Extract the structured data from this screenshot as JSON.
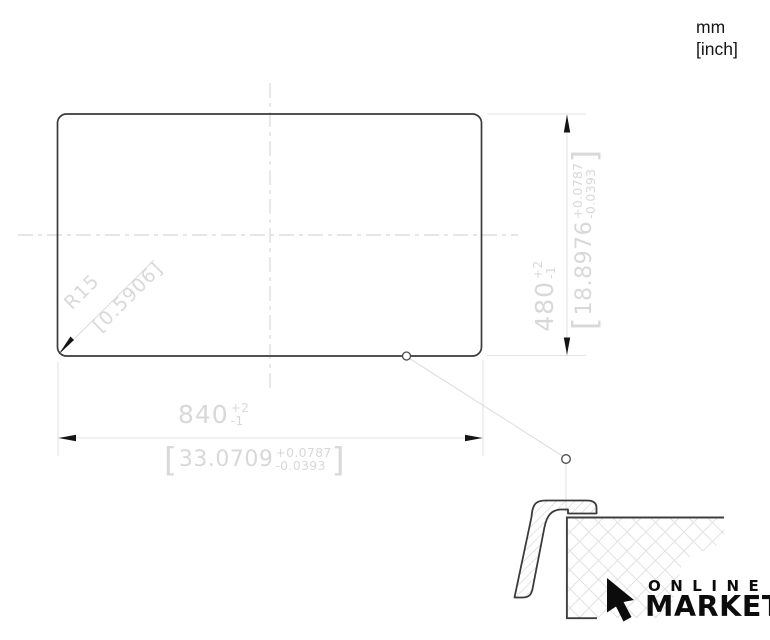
{
  "units": {
    "mm": "mm",
    "inch": "[inch]"
  },
  "symbols": {
    "bracket_open": "[",
    "bracket_close": "]"
  },
  "dims": {
    "width": {
      "mm": "840",
      "mm_plus": "+2",
      "mm_minus": "-1",
      "inch": "33.0709",
      "inch_plus": "+0.0787",
      "inch_minus": "-0.0393"
    },
    "height": {
      "mm": "480",
      "mm_plus": "+2",
      "mm_minus": "-1",
      "inch": "18.8976",
      "inch_plus": "+0.0787",
      "inch_minus": "-0.0393"
    },
    "radius": {
      "mm": "R15",
      "inch": "[0.5906]"
    }
  },
  "logo": {
    "line1": "ONLINE",
    "line2": "MARKET"
  },
  "colors": {
    "outline_dark": "#3a3a3a",
    "dimension_gray": "#d8d8d8",
    "construction_gray": "#e3e3e3",
    "arrow_black": "#151515",
    "logo_black": "#0c0c0c",
    "hatch_gray": "#c9c9c9",
    "crosshatch_gray": "#e2e2e2"
  }
}
